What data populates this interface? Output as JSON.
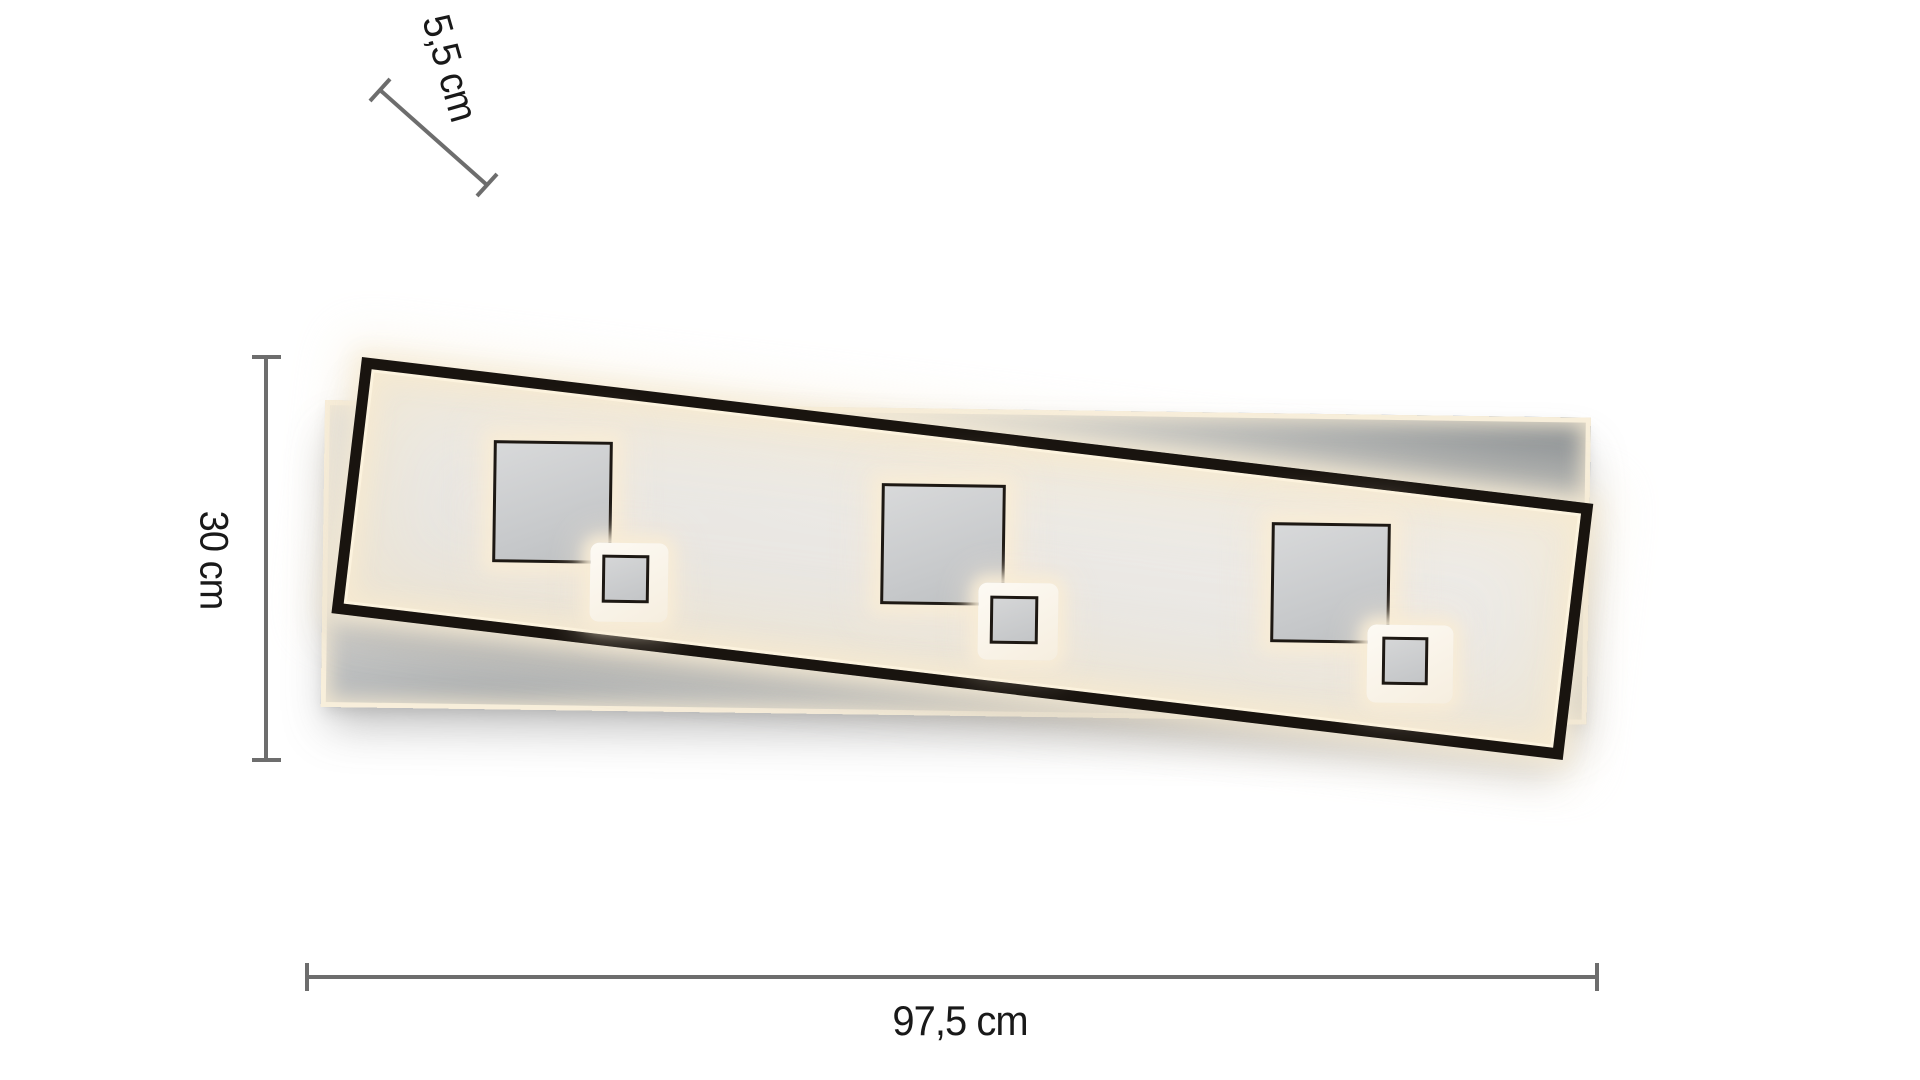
{
  "diagram": {
    "kind": "ceiling-light-dimension-diagram",
    "dimensions": {
      "depth": {
        "label": "5,5 cm",
        "value": "5,5",
        "unit": "cm"
      },
      "height": {
        "label": "30 cm",
        "value": "30",
        "unit": "cm"
      },
      "width": {
        "label": "97,5 cm",
        "value": "97,5",
        "unit": "cm"
      }
    },
    "fixture": {
      "square_pairs": 3,
      "panels": 2
    },
    "colors": {
      "background": "#ffffff",
      "frame_black": "#19140f",
      "panel_gray": "#cdd0d1",
      "glow_warm": "#f7ead2",
      "dimension_line": "#6d6d6d",
      "text": "#191919"
    }
  }
}
